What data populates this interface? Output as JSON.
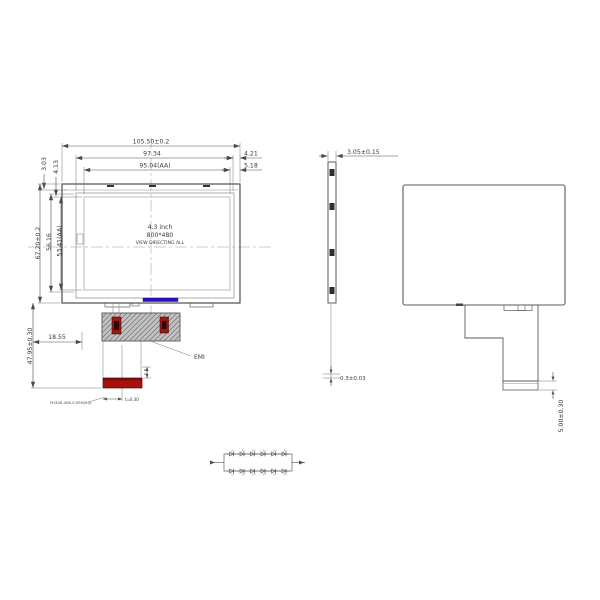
{
  "front_view": {
    "dims": {
      "overall_width": "105.50±0.2",
      "outline_width": "97.34",
      "active_width": "95.04(AA)",
      "right_gap_outline": "4.21",
      "right_gap_active": "5.18",
      "top_gap_outline": "3.03",
      "top_gap_active": "4.13",
      "overall_height": "67.20±0.2",
      "outline_height": "56.16",
      "active_height": "53.41(AA)",
      "fpc_length": "47.95±0.30",
      "fpc_offset": "18.55",
      "connector_lift": "1.5",
      "fpc_thickness": "t=0.30"
    },
    "labels": {
      "size": "4.3 inch",
      "resolution": "800*480",
      "view_direction": "VIEW DIRECTING ALL",
      "emi": "EMI",
      "connector_part": "FH34S-40S-0.5SH(50)"
    }
  },
  "side_view": {
    "dims": {
      "thickness": "3.05±0.15",
      "bottom_gap": "0.3±0.03"
    }
  },
  "back_view": {
    "dims": {
      "fpc_exit": "5.00±0.30"
    }
  },
  "backlight_circuit": {
    "strings": 2,
    "leds_per_string": 6,
    "led_total": 12
  },
  "colors": {
    "line": "#4a4a4a",
    "emi_shield": "#c3c3c3",
    "connector_red": "#a8120e",
    "component_red": "#9c1612",
    "component_core": "#2f0a08",
    "touch_fpc_blue": "#2a10c0",
    "tick_dark": "#333333"
  }
}
